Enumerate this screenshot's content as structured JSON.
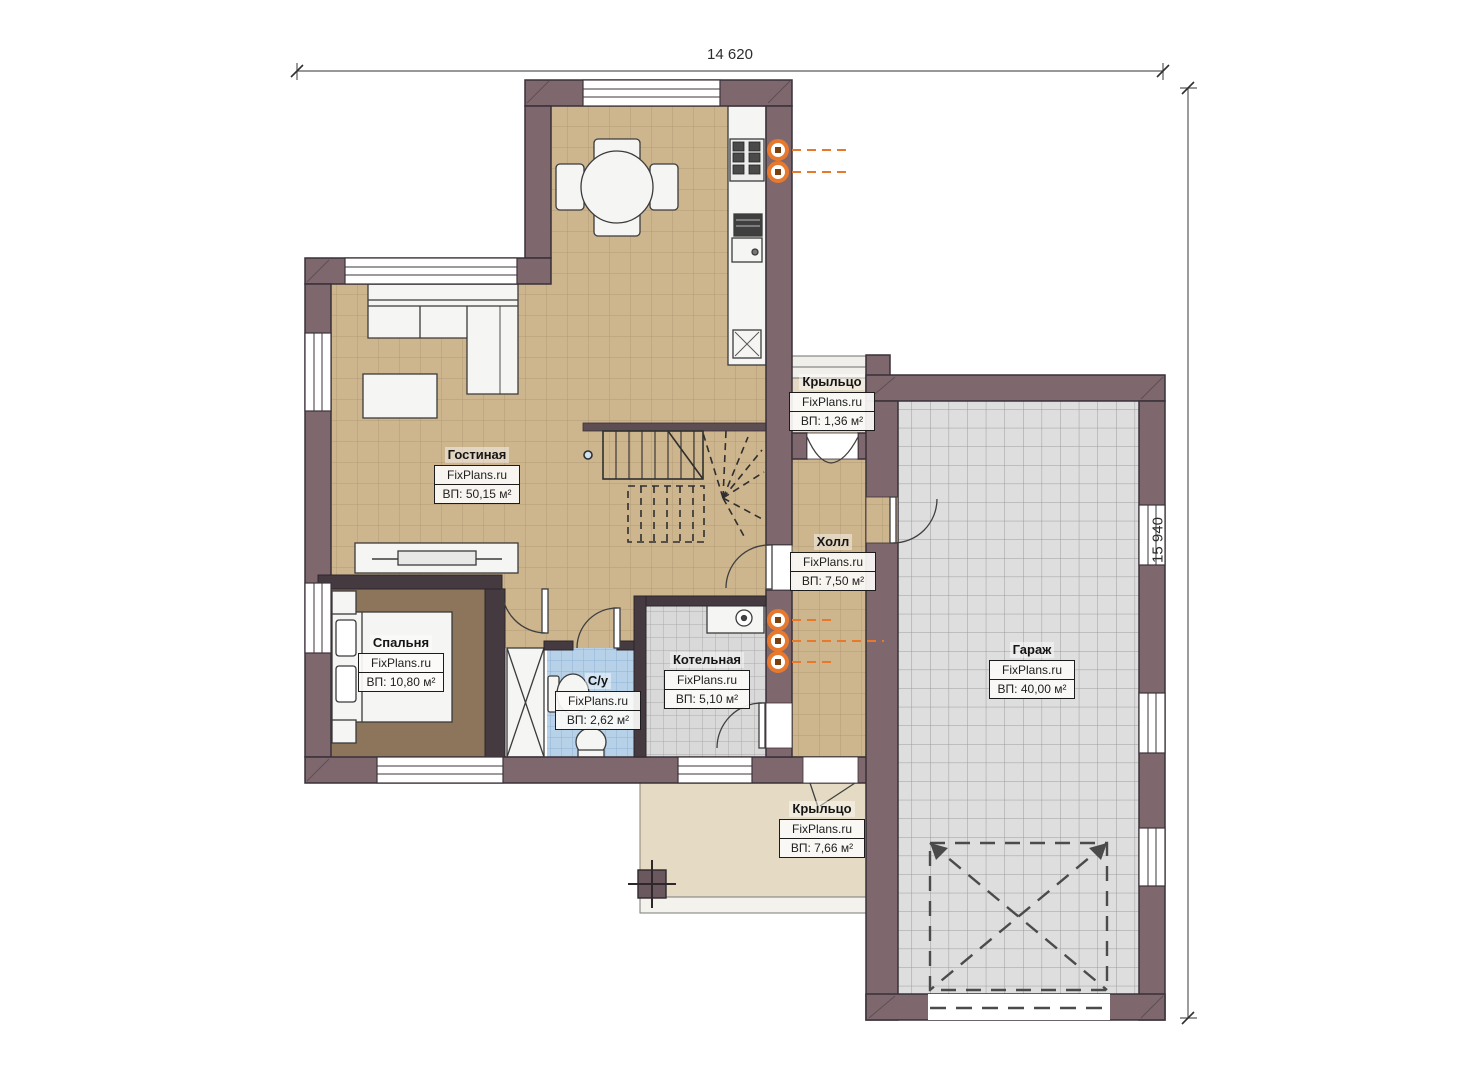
{
  "plan": {
    "watermark": "FixPlans.ru",
    "dimensions": {
      "width": "14 620",
      "height": "15 940"
    },
    "rooms": {
      "living": {
        "name": "Гостиная",
        "area": "ВП: 50,15 м²"
      },
      "bedroom": {
        "name": "Спальня",
        "area": "ВП: 10,80 м²"
      },
      "bathroom": {
        "name": "С/у",
        "area": "ВП: 2,62 м²"
      },
      "boiler": {
        "name": "Котельная",
        "area": "ВП: 5,10 м²"
      },
      "hall": {
        "name": "Холл",
        "area": "ВП: 7,50 м²"
      },
      "garage": {
        "name": "Гараж",
        "area": "ВП: 40,00 м²"
      },
      "porch_top": {
        "name": "Крыльцо",
        "area": "ВП: 1,36 м²"
      },
      "porch_bottom": {
        "name": "Крыльцо",
        "area": "ВП: 7,66 м²"
      }
    },
    "colors": {
      "wall_outer": "#7e686d",
      "wall_internal": "#443a40",
      "floor_tan": "#cdb58e",
      "floor_bedroom": "#8c755a",
      "floor_bath": "#b7d1e9",
      "floor_boiler": "#d9d9d9",
      "floor_garage": "#dedede",
      "porch": "#e5dbc4",
      "radiator": "#e8792c"
    }
  }
}
